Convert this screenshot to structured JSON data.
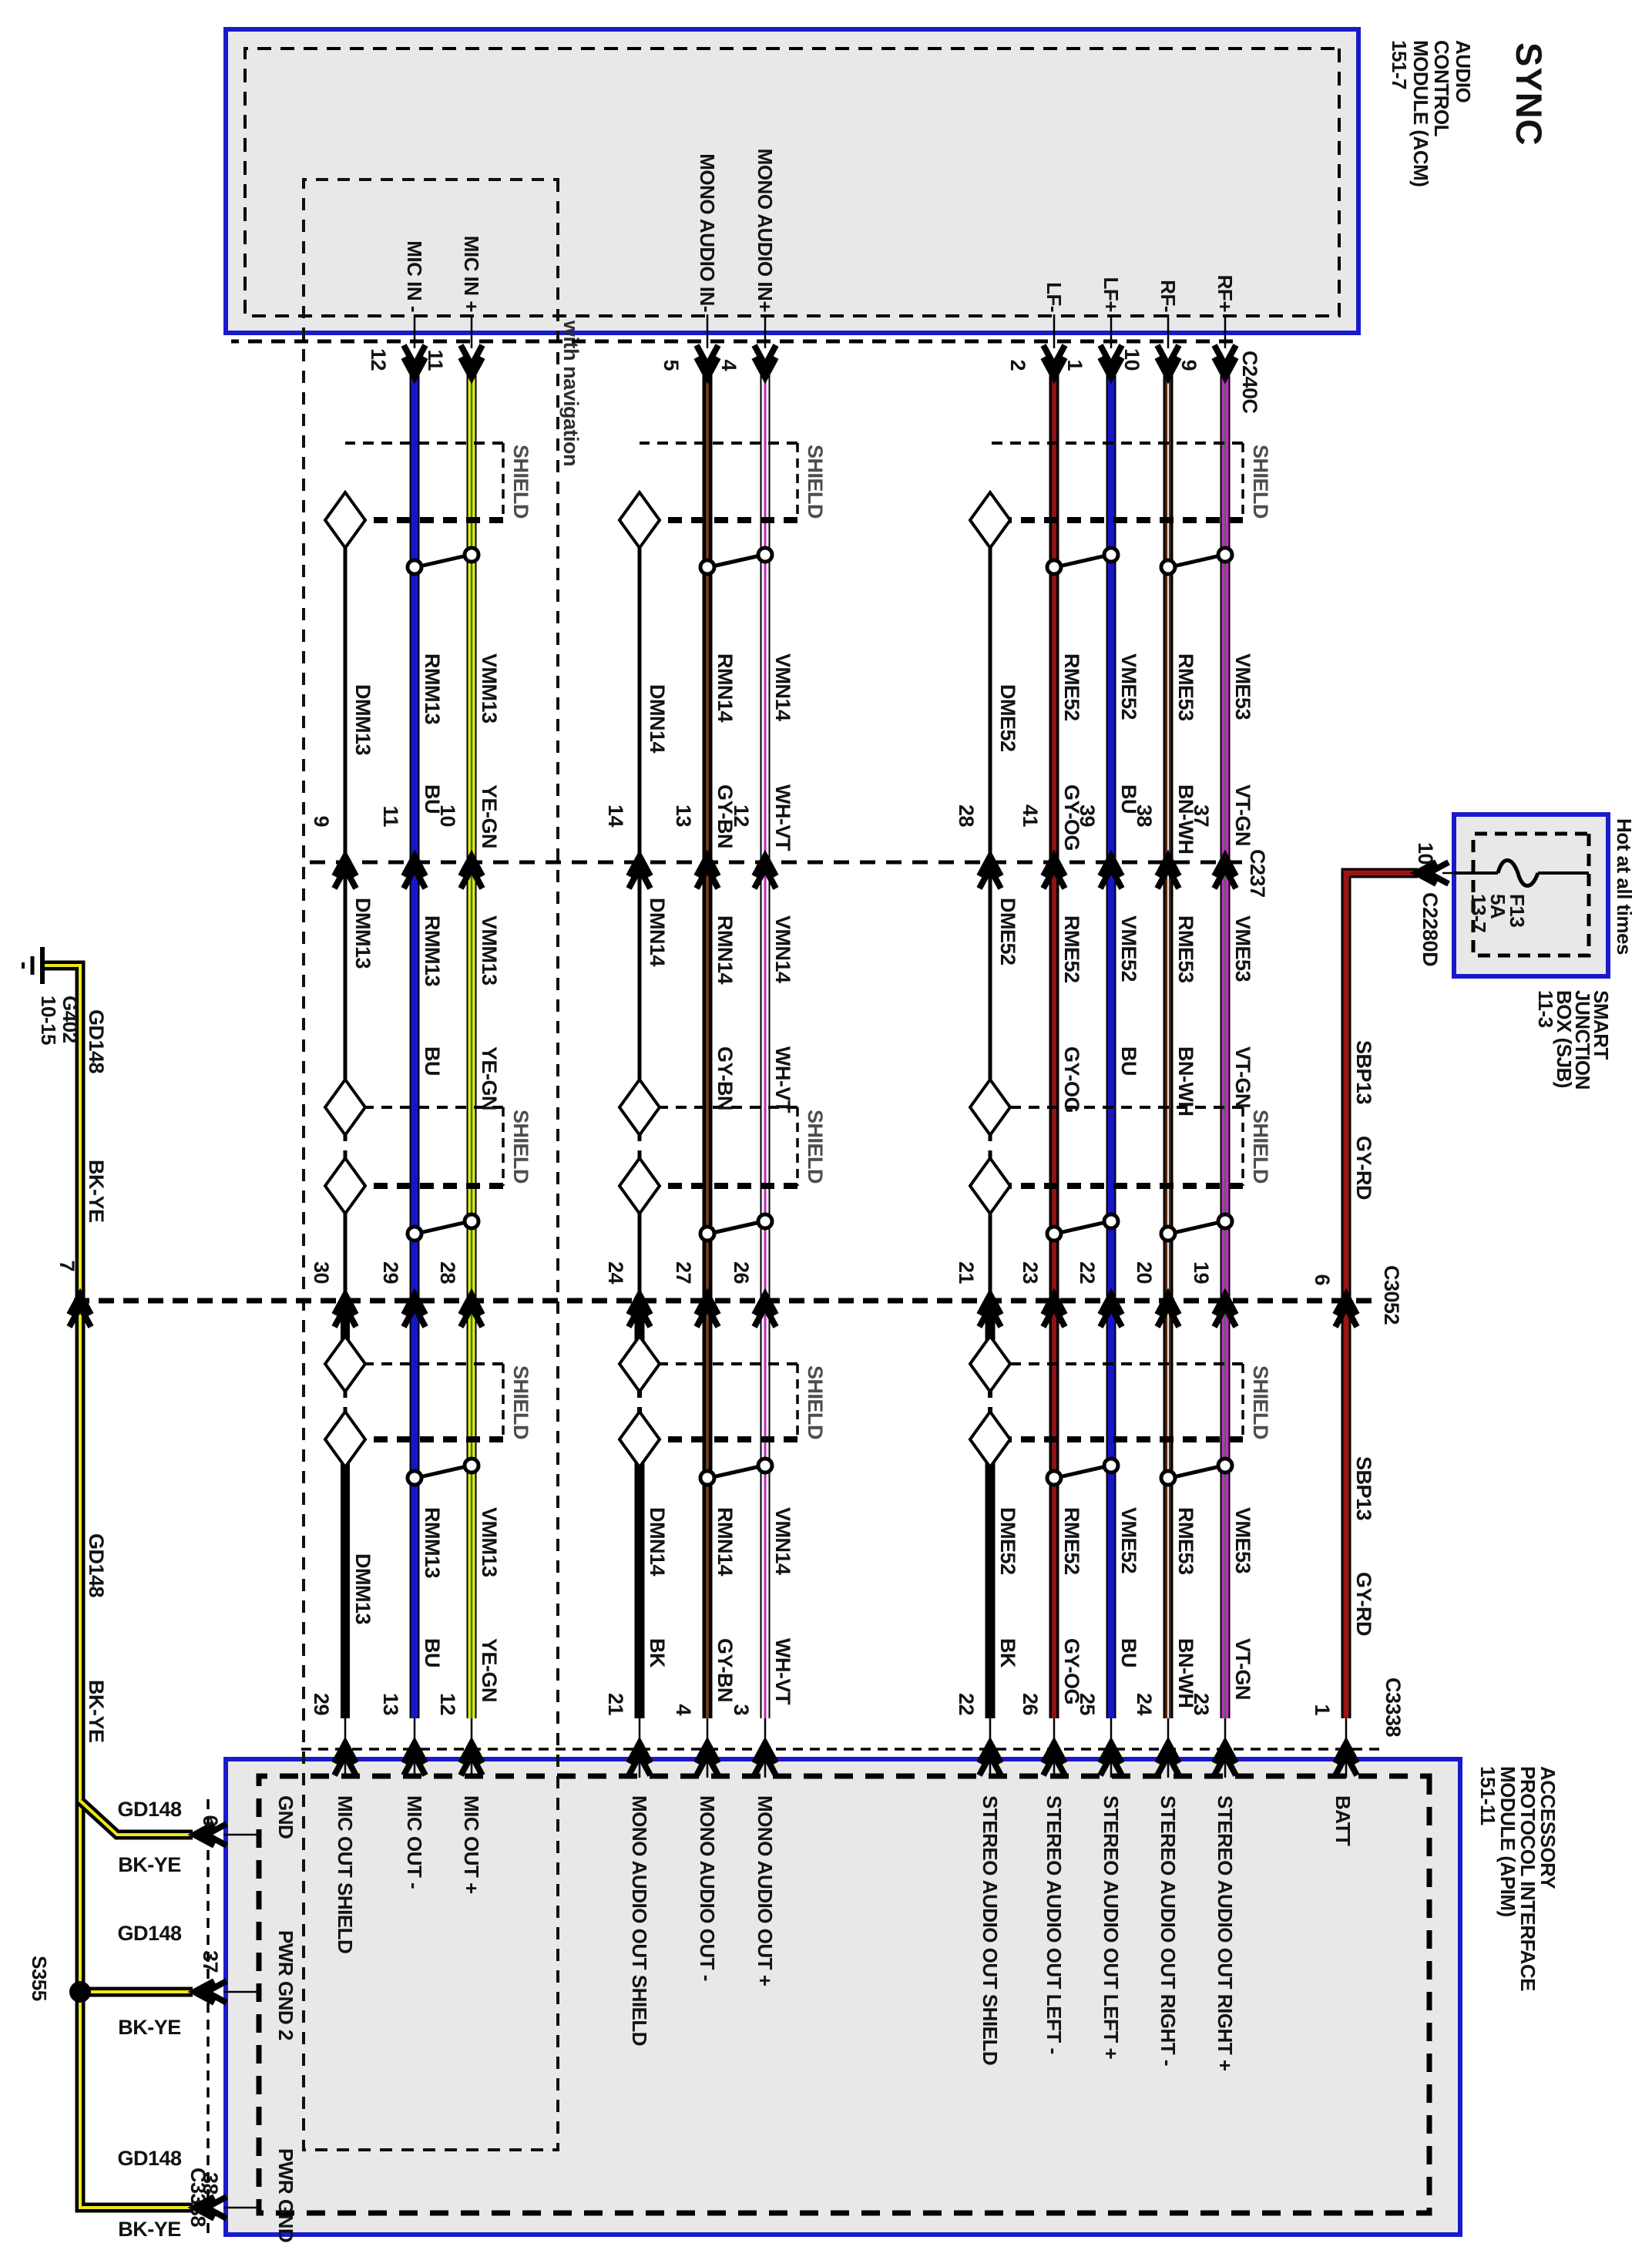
{
  "page_title": "SYNC",
  "shield_label": "SHIELD",
  "nav_label": "with navigation",
  "acm": {
    "title": [
      "AUDIO",
      "CONTROL",
      "MODULE (ACM)",
      "151-7"
    ],
    "connector": "C240C",
    "pin_labels": {
      "mic_minus": "MIC IN -",
      "mic_plus": "MIC IN +",
      "mono_minus": "MONO AUDIO IN-",
      "mono_plus": "MONO AUDIO IN+",
      "lf_minus": "LF-",
      "lf_plus": "LF+",
      "rf_minus": "RF-",
      "rf_plus": "RF+"
    },
    "pins": {
      "mic_minus": "12",
      "mic_plus": "11",
      "mono_minus": "5",
      "mono_plus": "4",
      "lf_minus": "2",
      "lf_plus": "1",
      "rf_minus": "10",
      "rf_plus": "9"
    }
  },
  "apim": {
    "title": [
      "ACCESSORY",
      "PROTOCOL INTERFACE",
      "MODULE (APIM)",
      "151-11"
    ],
    "pin_labels": {
      "gnd": "GND",
      "mic_shield": "MIC OUT SHIELD",
      "mic_minus": "MIC OUT -",
      "mic_plus": "MIC OUT +",
      "mono_shield": "MONO AUDIO OUT SHIELD",
      "mono_minus": "MONO AUDIO OUT -",
      "mono_plus": "MONO AUDIO OUT +",
      "st_shield": "STEREO AUDIO OUT SHIELD",
      "st_left_minus": "STEREO AUDIO OUT LEFT -",
      "st_left_plus": "STEREO AUDIO OUT LEFT +",
      "st_right_minus": "STEREO AUDIO OUT RIGHT -",
      "st_right_plus": "STEREO AUDIO OUT RIGHT +",
      "batt": "BATT",
      "pwr_gnd2": "PWR GND 2",
      "pwr_gnd": "PWR GND"
    }
  },
  "sjb": {
    "title": [
      "SMART",
      "JUNCTION",
      "BOX (SJB)",
      "11-3"
    ],
    "hot": "Hot at all times",
    "fuse": [
      "F13",
      "5A",
      "13-7"
    ],
    "connector": "C2280D",
    "pin": "10"
  },
  "connectors": {
    "c240c": "C240C",
    "c237": "C237",
    "c3052": "C3052",
    "c3338": "C3338"
  },
  "c237_pins": {
    "dmm": "9",
    "rmm": "11",
    "vmm": "10",
    "dmn": "14",
    "rmn": "13",
    "vmn": "12",
    "dme": "28",
    "rme52": "41",
    "vme52": "39",
    "rme53": "38",
    "vme53": "37"
  },
  "c3052_pins": {
    "dmm": "30",
    "rmm": "29",
    "vmm": "28",
    "dmn": "24",
    "rmn": "27",
    "vmn": "26",
    "dme": "21",
    "rme52": "23",
    "vme52": "22",
    "rme53": "20",
    "vme53": "19",
    "sbp": "6",
    "gnd": "7"
  },
  "c3338_pins": {
    "dmm": "29",
    "rmm": "13",
    "vmm": "12",
    "dmn": "21",
    "rmn": "4",
    "vmn": "3",
    "dme": "22",
    "rme52": "26",
    "vme52": "25",
    "rme53": "24",
    "vme53": "23",
    "sbp": "1",
    "gnd": "6",
    "pwr_gnd2": "37",
    "pwr_gnd": "38"
  },
  "wires": {
    "dmm": {
      "name": "DMM13"
    },
    "rmm": {
      "name": "RMM13",
      "color": "BU"
    },
    "vmm": {
      "name": "VMM13",
      "color": "YE-GN"
    },
    "dmn": {
      "name": "DMN14",
      "color": "BK"
    },
    "rmn": {
      "name": "RMN14",
      "color": "GY-BN"
    },
    "vmn": {
      "name": "VMN14",
      "color": "WH-VT"
    },
    "dme": {
      "name": "DME52",
      "color": "BK"
    },
    "rme52": {
      "name": "RME52",
      "color": "GY-OG"
    },
    "vme52": {
      "name": "VME52",
      "color": "BU"
    },
    "rme53": {
      "name": "RME53",
      "color": "BN-WH"
    },
    "vme53": {
      "name": "VME53",
      "color": "VT-GN"
    },
    "sbp": {
      "name": "SBP13",
      "color": "GY-RD"
    },
    "gnd": {
      "name": "GD148",
      "color": "BK-YE"
    }
  },
  "ground": {
    "g402": [
      "G402",
      "10-15"
    ],
    "splice": "S355"
  },
  "accent_colors": {
    "module_border": "#1a1acc",
    "module_fill": "#e8e8e8",
    "blue_wire": "#1616c8",
    "yellow": "#efe619",
    "green": "#1e8c1e",
    "violet": "#c42ac4",
    "dark_red": "#8f1313",
    "brown": "#5a2810",
    "power_red": "#9c1414"
  }
}
